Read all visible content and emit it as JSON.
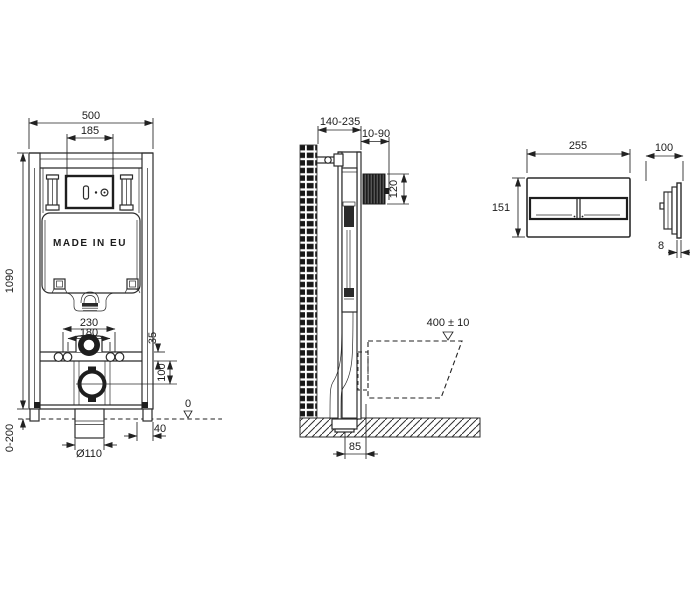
{
  "drawing": {
    "front_view": {
      "overall_width": "500",
      "tank_window_width": "185",
      "overall_height": "1090",
      "foot_adjustment": "0-200",
      "fixing_centers": "230",
      "flush_centers": "180",
      "offset_top": "35",
      "offset_drain": "100",
      "floor_datum": "0",
      "foot_depth": "40",
      "drain_diameter": "Ø110",
      "made_in_label": "MADE IN EU"
    },
    "side_view": {
      "frame_depth_range": "140-235",
      "wall_gap_range": "10-90",
      "inspection_height": "120",
      "bowl_height": "400 ± 10",
      "base_depth": "85"
    },
    "flush_plate_front": {
      "width": "255",
      "height": "151"
    },
    "flush_plate_side": {
      "depth": "100",
      "thickness": "8"
    }
  }
}
